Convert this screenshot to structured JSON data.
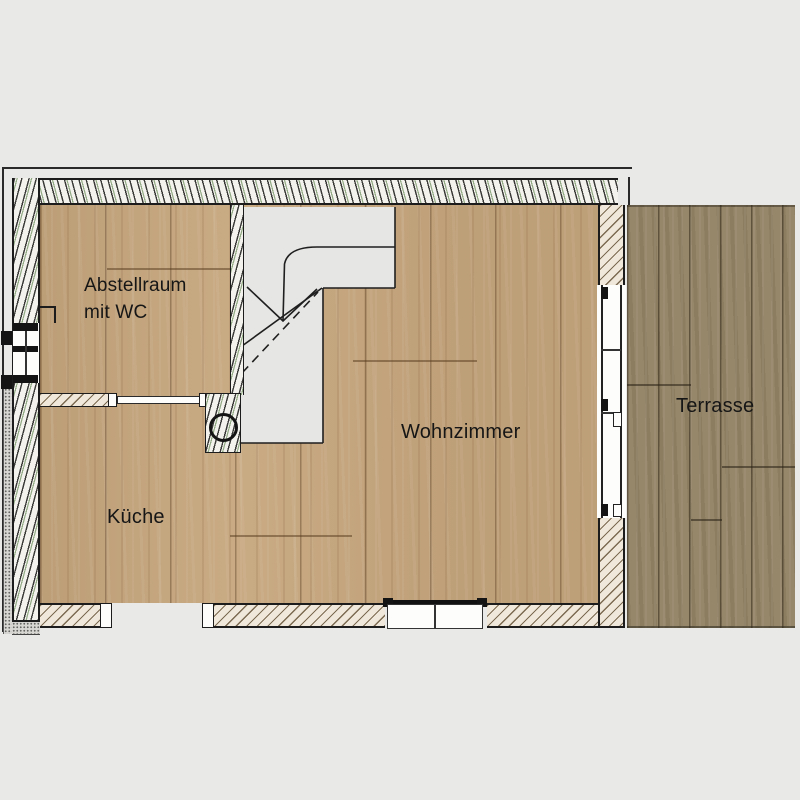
{
  "rooms": {
    "abstellraum": {
      "line1": "Abstellraum",
      "line2": "mit WC"
    },
    "kueche": {
      "label": "Küche"
    },
    "wohnzimmer": {
      "label": "Wohnzimmer"
    },
    "terrasse": {
      "label": "Terrasse"
    }
  },
  "colors": {
    "background": "#e9e9e8",
    "wood_interior": "#c6a67d",
    "wood_terrace": "#97876a",
    "wall_hatch_background": "#f3f2ec",
    "wall_hatch_green_accent": "#427030",
    "wall_hatch_beige": "#f0e9db",
    "stair_area": "#e6e6e4",
    "plan_line": "#1c1c1c"
  }
}
